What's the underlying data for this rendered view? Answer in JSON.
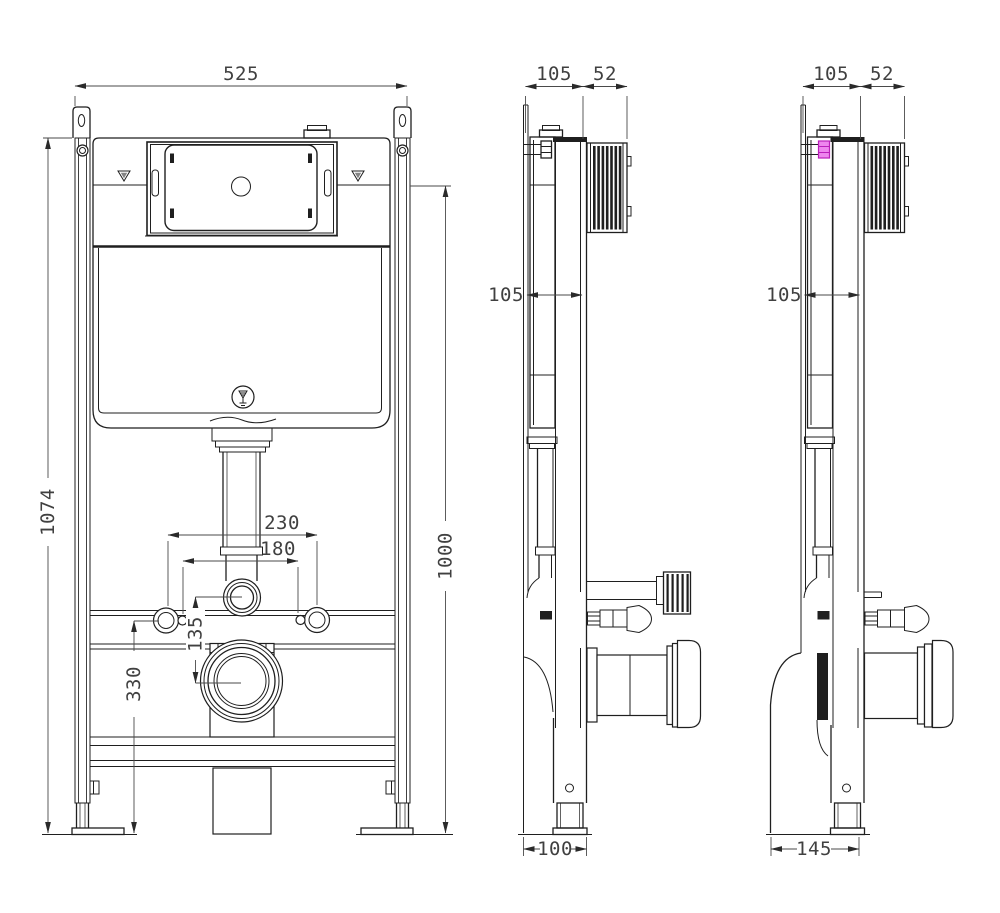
{
  "front_view": {
    "width_label": "525",
    "total_height_label": "1074",
    "fixing_height_label": "1000",
    "bolt_spacing_outer_label": "230",
    "bolt_spacing_inner_label": "180",
    "flush_pipe_offset_label": "135",
    "outlet_center_height_label": "330"
  },
  "side_view_center": {
    "frame_depth_label": "105",
    "plate_depth_label": "52",
    "cistern_depth_label": "105",
    "outlet_offset_label": "100"
  },
  "side_view_right": {
    "frame_depth_label": "105",
    "plate_depth_label": "52",
    "cistern_depth_label": "105",
    "outlet_offset_label": "145"
  },
  "colors": {
    "line": "#1f1f1f",
    "dim_text": "#404040",
    "highlight": "#ee86ee",
    "highlight_border": "#bb1fbb",
    "background": "#ffffff"
  }
}
